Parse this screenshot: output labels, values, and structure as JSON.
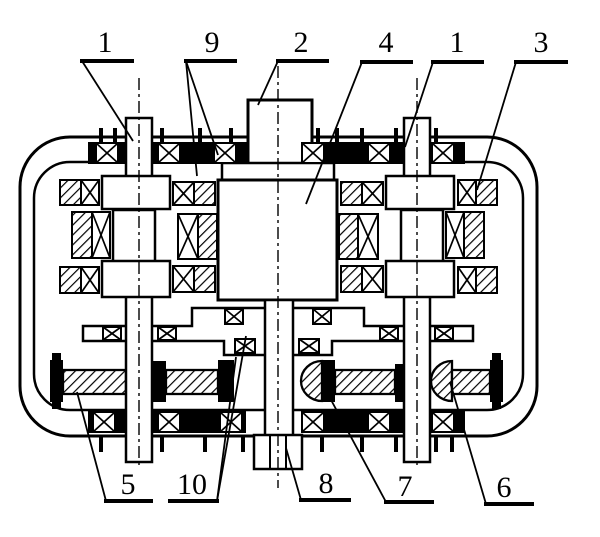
{
  "figure": {
    "background_color": "#ffffff",
    "ink_color": "#000000",
    "callouts": [
      {
        "id": "1-left",
        "text": "1",
        "tx": 105,
        "ty": 52,
        "bar": [
          80,
          61,
          134,
          61
        ],
        "leaders": [
          [
            82,
            61,
            133,
            141
          ]
        ]
      },
      {
        "id": "9",
        "text": "9",
        "tx": 212,
        "ty": 52,
        "bar": [
          184,
          61,
          237,
          61
        ],
        "leaders": [
          [
            186,
            61,
            197,
            176
          ],
          [
            186,
            61,
            218,
            155
          ]
        ]
      },
      {
        "id": "2",
        "text": "2",
        "tx": 301,
        "ty": 52,
        "bar": [
          276,
          61,
          329,
          61
        ],
        "leaders": [
          [
            278,
            61,
            258,
            105
          ]
        ]
      },
      {
        "id": "4",
        "text": "4",
        "tx": 386,
        "ty": 52,
        "bar": [
          360,
          62,
          413,
          62
        ],
        "leaders": [
          [
            362,
            62,
            306,
            204
          ]
        ]
      },
      {
        "id": "1-right",
        "text": "1",
        "tx": 457,
        "ty": 52,
        "bar": [
          431,
          62,
          484,
          62
        ],
        "leaders": [
          [
            433,
            62,
            405,
            147
          ]
        ]
      },
      {
        "id": "3",
        "text": "3",
        "tx": 541,
        "ty": 52,
        "bar": [
          514,
          62,
          568,
          62
        ],
        "leaders": [
          [
            516,
            62,
            477,
            190
          ]
        ]
      },
      {
        "id": "5",
        "text": "5",
        "tx": 128,
        "ty": 494,
        "bar": [
          104,
          501,
          153,
          501
        ],
        "leaders": [
          [
            106,
            501,
            77,
            392
          ]
        ]
      },
      {
        "id": "10",
        "text": "10",
        "tx": 192,
        "ty": 494,
        "bar": [
          168,
          501,
          219,
          501
        ],
        "leaders": [
          [
            217,
            501,
            246,
            336
          ],
          [
            217,
            501,
            236,
            357
          ]
        ]
      },
      {
        "id": "8",
        "text": "8",
        "tx": 326,
        "ty": 493,
        "bar": [
          299,
          500,
          351,
          500
        ],
        "leaders": [
          [
            301,
            500,
            286,
            448
          ]
        ]
      },
      {
        "id": "7",
        "text": "7",
        "tx": 405,
        "ty": 496,
        "bar": [
          384,
          502,
          434,
          502
        ],
        "leaders": [
          [
            386,
            502,
            330,
            398
          ]
        ]
      },
      {
        "id": "6",
        "text": "6",
        "tx": 504,
        "ty": 497,
        "bar": [
          484,
          504,
          534,
          504
        ],
        "leaders": [
          [
            486,
            504,
            450,
            382
          ]
        ]
      }
    ]
  }
}
